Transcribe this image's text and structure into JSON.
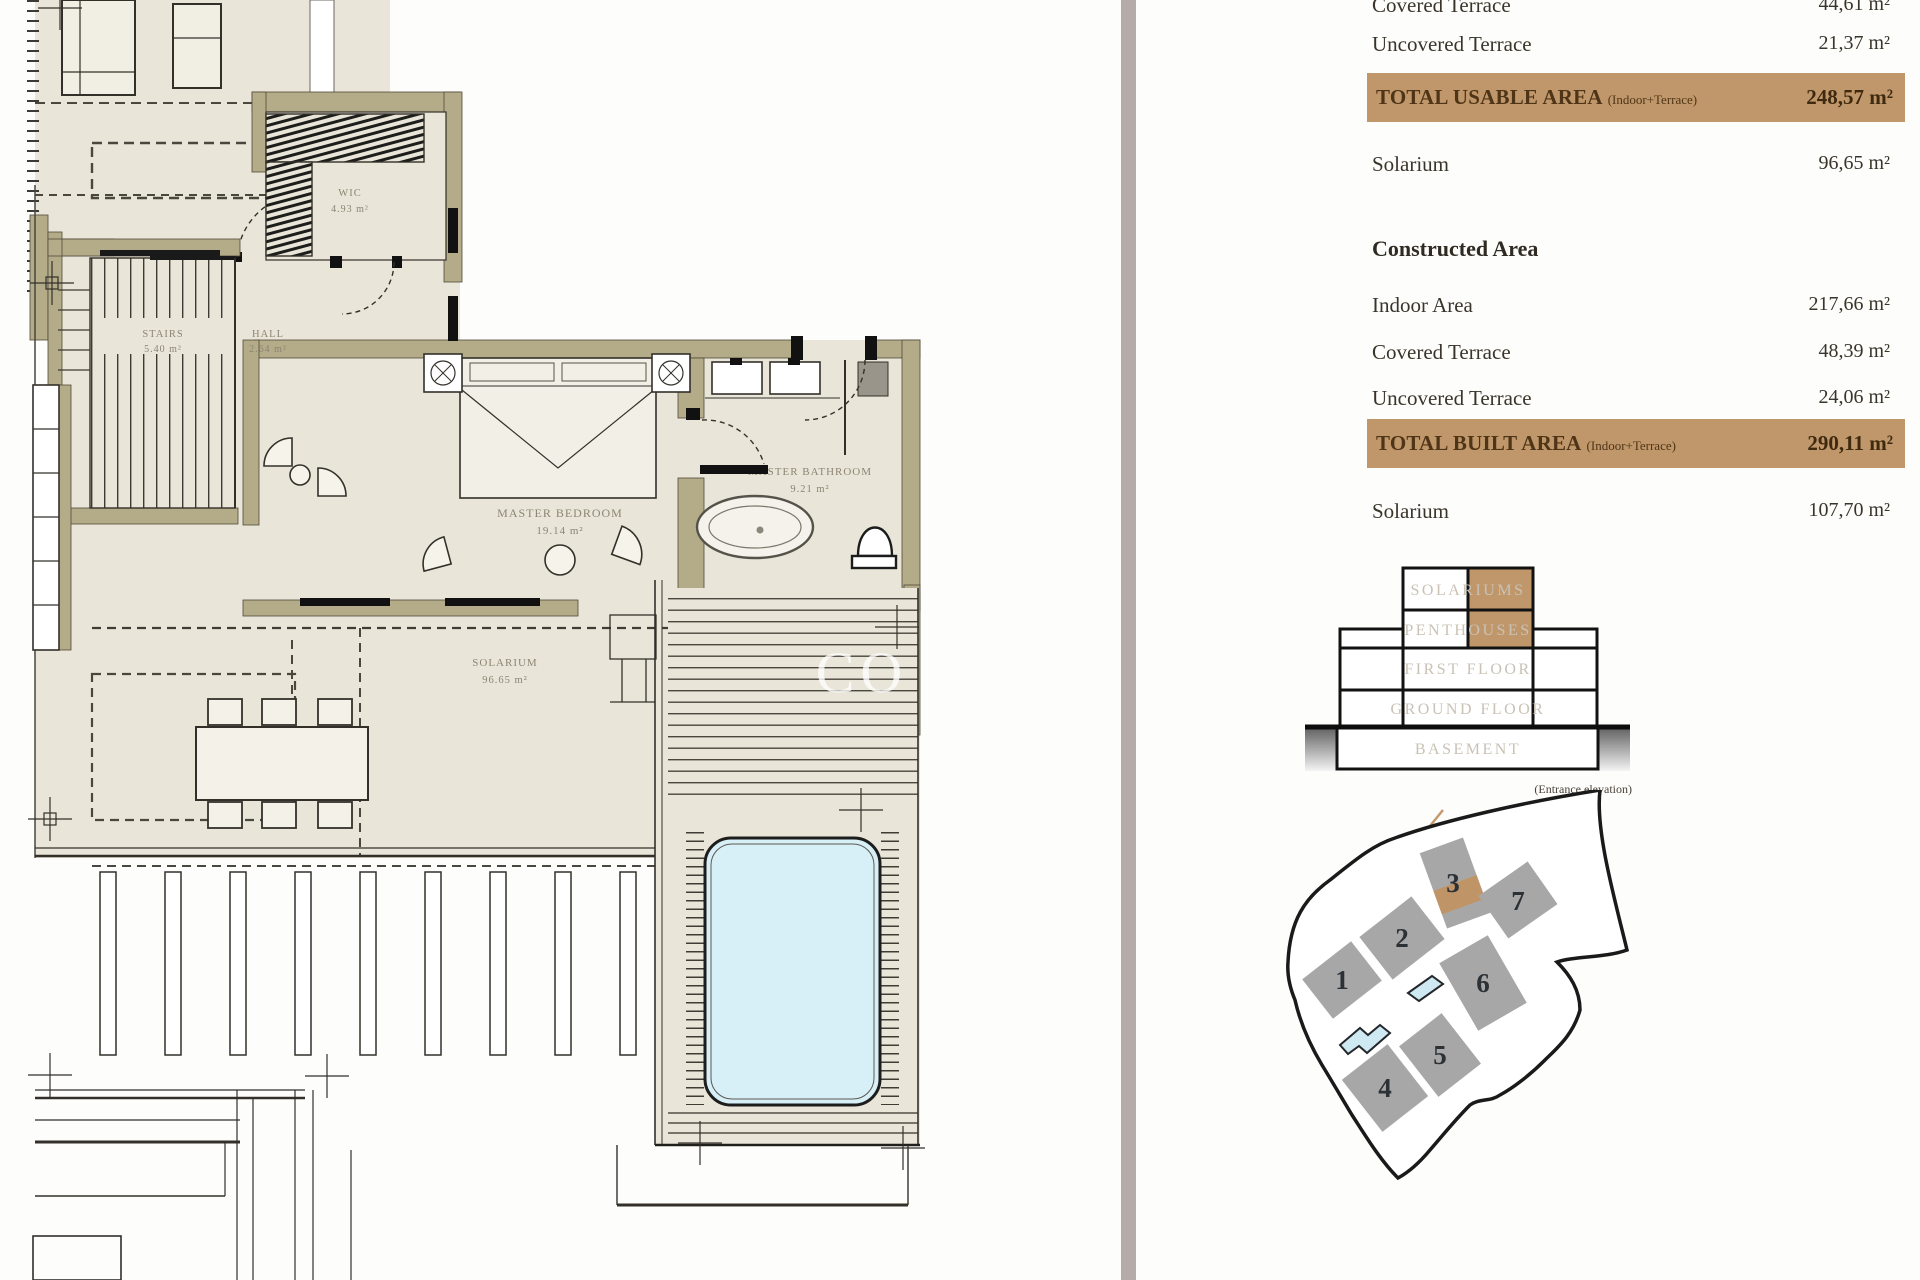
{
  "panel": {
    "usable_rows": [
      {
        "label": "Covered Terrace",
        "value": "44,61 m²"
      },
      {
        "label": "Uncovered Terrace",
        "value": "21,37 m²"
      }
    ],
    "usable_total": {
      "label": "TOTAL USABLE AREA",
      "qualifier": "(Indoor+Terrace)",
      "value": "248,57 m²"
    },
    "usable_solarium": {
      "label": "Solarium",
      "value": "96,65 m²"
    },
    "constructed_heading": "Constructed Area",
    "constructed_rows": [
      {
        "label": "Indoor Area",
        "value": "217,66 m²"
      },
      {
        "label": "Covered Terrace",
        "value": "48,39 m²"
      },
      {
        "label": "Uncovered Terrace",
        "value": "24,06 m²"
      }
    ],
    "built_total": {
      "label": "TOTAL BUILT AREA",
      "qualifier": "(Indoor+Terrace)",
      "value": "290,11 m²"
    },
    "built_solarium": {
      "label": "Solarium",
      "value": "107,70 m²"
    }
  },
  "elevation": {
    "floors": [
      "SOLARIUMS",
      "PENTHOUSES",
      "FIRST FLOOR",
      "GROUND FLOOR",
      "BASEMENT"
    ],
    "caption": "(Entrance elevation)"
  },
  "site": {
    "buildings": [
      "1",
      "2",
      "3",
      "4",
      "5",
      "6",
      "7"
    ],
    "highlighted_building": "3"
  },
  "plan": {
    "stairs_name": "STAIRS",
    "stairs_area": "5.40 m²",
    "hall_name": "HALL",
    "hall_area": "2.64 m²",
    "wic_name": "WIC",
    "wic_area": "4.93 m²",
    "bedroom_name": "MASTER BEDROOM",
    "bedroom_area": "19.14 m²",
    "bathroom_name": "MASTER BATHROOM",
    "bathroom_area": "9.21 m²",
    "solarium_name": "SOLARIUM",
    "solarium_area": "96.65 m²",
    "watermark": "CO"
  },
  "colors": {
    "highlight": "#c0976a",
    "wall": "#b4ab88",
    "floor": "#e9e6d9",
    "pool": "#d7eff7",
    "separator": "#b5acaa"
  }
}
